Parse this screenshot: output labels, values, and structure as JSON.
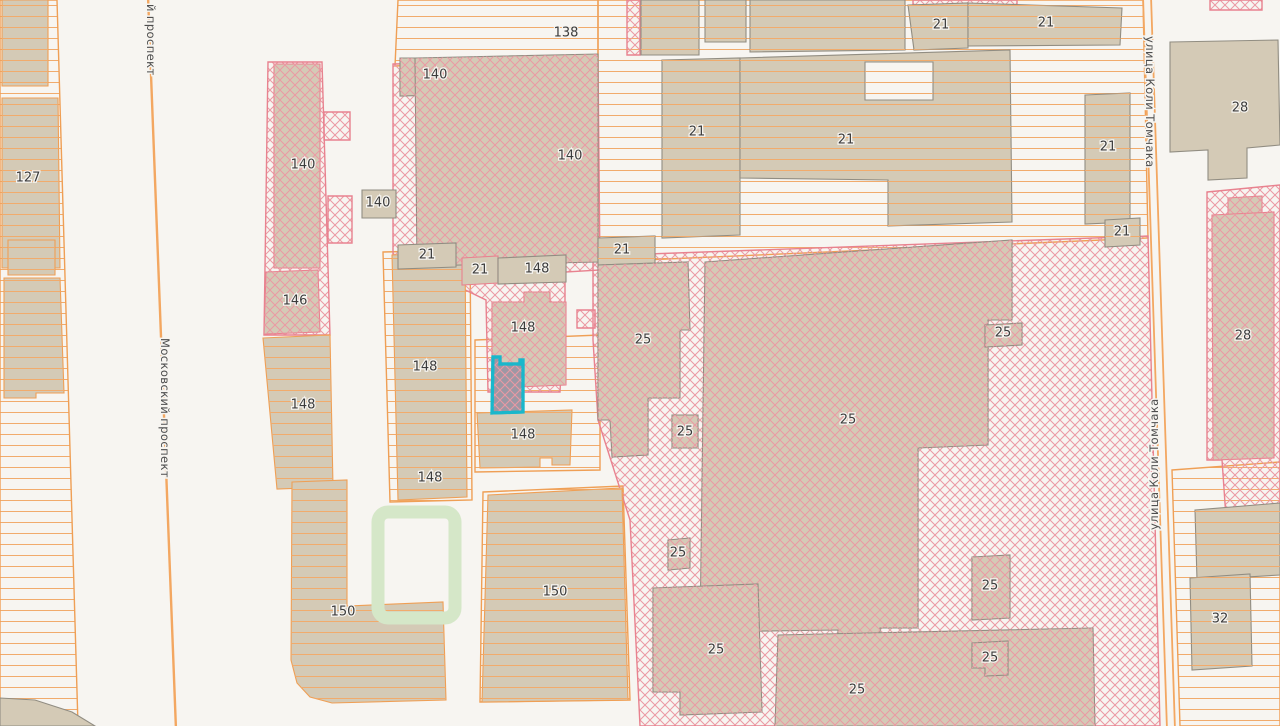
{
  "map": {
    "width": 1280,
    "height": 726,
    "colors": {
      "background": "#f7f5f1",
      "tan": "#d4cab6",
      "bg": "#f7f5f1",
      "selected": "#9d97a4",
      "gray": "#918d82",
      "orange": "#ef9f55",
      "pink": "#e8828f",
      "teal": "#19b7cb",
      "stripe_line": "#f1ab6c",
      "hatch_line": "#eb98a3",
      "road": "#f3a761",
      "green": "#d5e7c8",
      "label": "#3c3c3c",
      "street_label": "#4e4e4e"
    },
    "parcels": [
      {
        "pattern": "stripes",
        "stroke": "orange",
        "points": "0,0 57,0 78,726 0,726"
      },
      {
        "pattern": "stripes",
        "stroke": "orange",
        "points": "398,0 598,0 598,58 395,66"
      },
      {
        "pattern": "stripes",
        "stroke": "orange",
        "points": "598,0 1143,0 1148,238 598,262"
      },
      {
        "pattern": "stripes",
        "stroke": "orange",
        "points": "383,252 470,250 472,500 390,502"
      },
      {
        "pattern": "stripes",
        "stroke": "orange",
        "points": "475,340 600,335 600,470 475,472"
      },
      {
        "pattern": "stripes",
        "stroke": "orange",
        "points": "483,492 623,486 630,700 480,702"
      },
      {
        "pattern": "stripes",
        "stroke": "orange",
        "points": "1172,470 1280,462 1280,726 1180,726"
      },
      {
        "pattern": "hatch",
        "stroke": "pink",
        "points": "268,62 322,62 330,335 264,335"
      },
      {
        "pattern": "hatch",
        "stroke": "pink",
        "points": "393,64 598,60 600,270 565,272 565,300 560,392 488,392 486,300 455,285 450,272 393,272"
      },
      {
        "pattern": "hatch",
        "stroke": "pink",
        "points": "593,256 1148,236 1160,726 640,726 630,520 598,420 593,340"
      },
      {
        "pattern": "hatch",
        "stroke": "pink",
        "points": "1207,192 1280,185 1280,530 1227,532 1222,460 1207,460"
      },
      {
        "pattern": "hatch",
        "stroke": "pink",
        "points": "913,0 1017,0 1017,7 913,7"
      },
      {
        "pattern": "hatch",
        "stroke": "pink",
        "points": "1210,0 1262,0 1262,10 1210,10"
      },
      {
        "pattern": "hatch",
        "stroke": "pink",
        "points": "627,0 640,0 640,55 627,55"
      },
      {
        "pattern": "hatch",
        "stroke": "pink",
        "points": "328,196 352,196 352,243 328,243"
      },
      {
        "pattern": "hatch",
        "stroke": "pink",
        "points": "324,112 350,112 350,140 324,140"
      },
      {
        "pattern": "hatch",
        "stroke": "pink",
        "points": "577,310 595,310 595,328 577,328"
      }
    ],
    "buildings": [
      {
        "name": "building-127-a",
        "fill": "tan",
        "pattern": "stripes",
        "stroke": "orange",
        "points": "2,0 48,0 48,86 2,86"
      },
      {
        "name": "building-127",
        "fill": "tan",
        "pattern": "stripes",
        "stroke": "orange",
        "points": "2,98 58,98 60,268 2,268"
      },
      {
        "name": "building-127-b",
        "fill": "tan",
        "pattern": "stripes",
        "stroke": "orange",
        "points": "8,240 55,240 55,275 8,275"
      },
      {
        "name": "building-127-c",
        "fill": "tan",
        "pattern": "stripes",
        "stroke": "orange",
        "points": "4,278 60,278 64,393 36,393 36,398 4,398"
      },
      {
        "name": "building-corner",
        "fill": "tan",
        "pattern": "none",
        "stroke": "gray",
        "points": "0,698 35,700 72,712 95,726 0,726"
      },
      {
        "name": "building-148-left",
        "fill": "tan",
        "pattern": "stripes",
        "stroke": "orange",
        "points": "263,338 330,335 333,487 277,489"
      },
      {
        "name": "building-150-L",
        "fill": "tan",
        "pattern": "stripes",
        "stroke": "orange",
        "points": "292,482 347,480 347,606 443,602 446,700 332,703 310,697 297,683 291,660"
      },
      {
        "name": "building-148-tall",
        "fill": "tan",
        "pattern": "stripes",
        "stroke": "orange",
        "points": "392,255 465,252 467,497 398,500"
      },
      {
        "name": "building-150-center",
        "fill": "tan",
        "pattern": "stripes",
        "stroke": "orange",
        "points": "488,495 622,488 628,700 482,702"
      },
      {
        "name": "building-140-column",
        "fill": "tan",
        "pattern": "hatch",
        "stroke": "pink",
        "points": "274,64 320,64 320,268 274,268"
      },
      {
        "name": "building-146",
        "fill": "tan",
        "pattern": "hatch",
        "stroke": "pink",
        "points": "266,272 318,270 320,332 264,334"
      },
      {
        "name": "building-140-small-top",
        "fill": "tan",
        "pattern": "hatch",
        "stroke": "gray",
        "points": "400,58 480,58 480,94 400,96"
      },
      {
        "name": "building-140-big",
        "fill": "tan",
        "pattern": "hatch",
        "stroke": "gray",
        "points": "415,58 598,54 598,262 417,266"
      },
      {
        "name": "building-140-box",
        "fill": "tan",
        "pattern": "none",
        "stroke": "gray",
        "points": "362,190 396,190 396,218 362,218"
      },
      {
        "name": "building-21-wide",
        "fill": "tan",
        "pattern": "none",
        "stroke": "gray",
        "points": "398,245 456,243 456,267 398,269"
      },
      {
        "name": "building-21-box",
        "fill": "tan",
        "pattern": "none",
        "stroke": "pink",
        "points": "462,258 498,256 498,283 462,285"
      },
      {
        "name": "building-148-wide",
        "fill": "tan",
        "pattern": "none",
        "stroke": "gray",
        "points": "498,258 566,255 566,282 498,284"
      },
      {
        "name": "building-148-hatched",
        "fill": "tan",
        "pattern": "hatch",
        "stroke": "pink",
        "points": "492,302 524,302 524,292 550,292 550,302 566,302 566,385 492,388"
      },
      {
        "name": "building-148-below",
        "fill": "tan",
        "pattern": "stripes",
        "stroke": "orange",
        "points": "477,413 572,410 570,465 552,465 552,458 540,458 540,467 480,468"
      },
      {
        "name": "building-top-a",
        "fill": "tan",
        "pattern": "stripes",
        "stroke": "gray",
        "points": "641,0 699,0 699,55 641,55"
      },
      {
        "name": "building-top-b",
        "fill": "tan",
        "pattern": "stripes",
        "stroke": "gray",
        "points": "705,0 746,0 746,42 705,42"
      },
      {
        "name": "building-top-c",
        "fill": "tan",
        "pattern": "stripes",
        "stroke": "gray",
        "points": "750,0 905,0 905,50 750,52"
      },
      {
        "name": "building-21-top-left",
        "fill": "tan",
        "pattern": "stripes",
        "stroke": "gray",
        "points": "908,5 968,3 968,48 914,50"
      },
      {
        "name": "building-21-top-right",
        "fill": "tan",
        "pattern": "stripes",
        "stroke": "gray",
        "points": "968,3 1122,8 1120,45 968,46"
      },
      {
        "name": "building-21-main-left",
        "fill": "tan",
        "pattern": "stripes",
        "stroke": "gray",
        "points": "662,60 740,58 740,235 662,238"
      },
      {
        "name": "building-21-main-right",
        "fill": "tan",
        "pattern": "stripes",
        "stroke": "gray",
        "points": "740,58 1010,50 1012,222 888,226 888,180 740,178"
      },
      {
        "name": "building-21-courtyard",
        "fill": "bg",
        "pattern": "stripes",
        "stroke": "gray",
        "points": "865,62 933,62 933,100 865,100"
      },
      {
        "name": "building-21-small",
        "fill": "tan",
        "pattern": "stripes",
        "stroke": "gray",
        "points": "598,238 655,236 655,263 598,265"
      },
      {
        "name": "building-21-east",
        "fill": "tan",
        "pattern": "stripes",
        "stroke": "gray",
        "points": "1085,95 1130,93 1130,222 1085,224"
      },
      {
        "name": "building-21-east-small",
        "fill": "tan",
        "pattern": "stripes",
        "stroke": "gray",
        "points": "1105,220 1140,218 1140,245 1105,247"
      },
      {
        "name": "building-25-west",
        "fill": "tan",
        "pattern": "hatch",
        "stroke": "gray",
        "points": "598,265 688,262 690,330 680,330 680,398 648,398 648,455 612,457 610,420 598,420"
      },
      {
        "name": "building-25-box-a",
        "fill": "tan",
        "pattern": "hatch",
        "stroke": "gray",
        "points": "672,415 698,415 698,448 672,448"
      },
      {
        "name": "building-25-big",
        "fill": "tan",
        "pattern": "hatch",
        "stroke": "gray",
        "points": "705,262 1012,240 1012,320 988,320 988,445 918,448 918,628 880,628 880,648 838,648 838,630 700,632"
      },
      {
        "name": "building-25-box-b",
        "fill": "tan",
        "pattern": "hatch",
        "stroke": "gray",
        "points": "668,540 690,538 690,568 668,570"
      },
      {
        "name": "building-25-lower-left",
        "fill": "tan",
        "pattern": "hatch",
        "stroke": "gray",
        "points": "653,588 758,584 762,712 680,715 680,692 653,692"
      },
      {
        "name": "building-25-wide",
        "fill": "tan",
        "pattern": "hatch",
        "stroke": "gray",
        "points": "778,635 1093,628 1095,726 775,726"
      },
      {
        "name": "building-25-box-c",
        "fill": "tan",
        "pattern": "hatch",
        "stroke": "gray",
        "points": "972,557 1010,555 1010,618 972,620"
      },
      {
        "name": "building-25-box-d",
        "fill": "tan",
        "pattern": "hatch",
        "stroke": "gray",
        "points": "972,643 1008,641 1008,675 985,676 985,668 972,668"
      },
      {
        "name": "building-25-box-e",
        "fill": "tan",
        "pattern": "hatch",
        "stroke": "gray",
        "points": "985,325 1022,323 1022,345 985,347"
      },
      {
        "name": "building-28-top",
        "fill": "tan",
        "pattern": "none",
        "stroke": "gray",
        "points": "1170,42 1278,40 1280,145 1247,148 1247,178 1208,180 1208,150 1170,152"
      },
      {
        "name": "building-28-tab",
        "fill": "tan",
        "pattern": "hatch",
        "stroke": "pink",
        "points": "1228,198 1262,196 1262,215 1228,217"
      },
      {
        "name": "building-28-mid",
        "fill": "tan",
        "pattern": "hatch",
        "stroke": "pink",
        "points": "1212,215 1274,212 1274,458 1213,460"
      },
      {
        "name": "building-right-edge",
        "fill": "tan",
        "pattern": "stripes",
        "stroke": "gray",
        "points": "1195,510 1280,503 1280,575 1197,580"
      },
      {
        "name": "building-32",
        "fill": "tan",
        "pattern": "stripes",
        "stroke": "gray",
        "points": "1190,578 1250,574 1252,666 1192,670"
      },
      {
        "name": "selected-building",
        "fill": "selected",
        "pattern": "hatch",
        "stroke": "teal",
        "points": "493,357 500,357 500,364 520,364 520,360 523,360 523,412 492,413"
      }
    ],
    "green_areas": [
      {
        "x": 378,
        "y": 512,
        "w": 77,
        "h": 106
      }
    ],
    "roads": [
      {
        "name": "moskovsky-prospekt-line",
        "points": "148,-4 176,730",
        "width": 2.4
      },
      {
        "name": "kolya-tomchaka-line-west",
        "points": "1143,-4 1167,730",
        "width": 1.8
      },
      {
        "name": "kolya-tomchaka-line-east",
        "points": "1151,-4 1175,730",
        "width": 1.8
      }
    ],
    "street_labels": [
      {
        "text": "й проспект",
        "x": 147,
        "y": 4,
        "rotation": 90
      },
      {
        "text": "Московский проспект",
        "x": 161,
        "y": 338,
        "rotation": 90
      },
      {
        "text": "улица Коли Томчака",
        "x": 1146,
        "y": 36,
        "rotation": 90
      },
      {
        "text": "улица Коли Томчака",
        "x": 1158,
        "y": 530,
        "rotation": -90
      }
    ],
    "building_labels": [
      {
        "text": "127",
        "x": 28,
        "y": 178
      },
      {
        "text": "138",
        "x": 566,
        "y": 33
      },
      {
        "text": "140",
        "x": 435,
        "y": 75
      },
      {
        "text": "140",
        "x": 570,
        "y": 156
      },
      {
        "text": "140",
        "x": 303,
        "y": 165
      },
      {
        "text": "140",
        "x": 378,
        "y": 203
      },
      {
        "text": "146",
        "x": 295,
        "y": 301
      },
      {
        "text": "148",
        "x": 537,
        "y": 269
      },
      {
        "text": "148",
        "x": 523,
        "y": 328
      },
      {
        "text": "148",
        "x": 425,
        "y": 367
      },
      {
        "text": "148",
        "x": 303,
        "y": 405
      },
      {
        "text": "148",
        "x": 523,
        "y": 435
      },
      {
        "text": "148",
        "x": 430,
        "y": 478
      },
      {
        "text": "150",
        "x": 343,
        "y": 612
      },
      {
        "text": "150",
        "x": 555,
        "y": 592
      },
      {
        "text": "21",
        "x": 941,
        "y": 25
      },
      {
        "text": "21",
        "x": 1046,
        "y": 23
      },
      {
        "text": "21",
        "x": 697,
        "y": 132
      },
      {
        "text": "21",
        "x": 846,
        "y": 140
      },
      {
        "text": "21",
        "x": 1108,
        "y": 147
      },
      {
        "text": "21",
        "x": 1122,
        "y": 232
      },
      {
        "text": "21",
        "x": 622,
        "y": 250
      },
      {
        "text": "21",
        "x": 427,
        "y": 255
      },
      {
        "text": "21",
        "x": 480,
        "y": 270
      },
      {
        "text": "25",
        "x": 643,
        "y": 340
      },
      {
        "text": "25",
        "x": 1003,
        "y": 333
      },
      {
        "text": "25",
        "x": 848,
        "y": 420
      },
      {
        "text": "25",
        "x": 685,
        "y": 432
      },
      {
        "text": "25",
        "x": 678,
        "y": 553
      },
      {
        "text": "25",
        "x": 990,
        "y": 586
      },
      {
        "text": "25",
        "x": 716,
        "y": 650
      },
      {
        "text": "25",
        "x": 990,
        "y": 658
      },
      {
        "text": "25",
        "x": 857,
        "y": 690
      },
      {
        "text": "28",
        "x": 1240,
        "y": 108
      },
      {
        "text": "28",
        "x": 1243,
        "y": 336
      },
      {
        "text": "32",
        "x": 1220,
        "y": 619
      }
    ]
  }
}
